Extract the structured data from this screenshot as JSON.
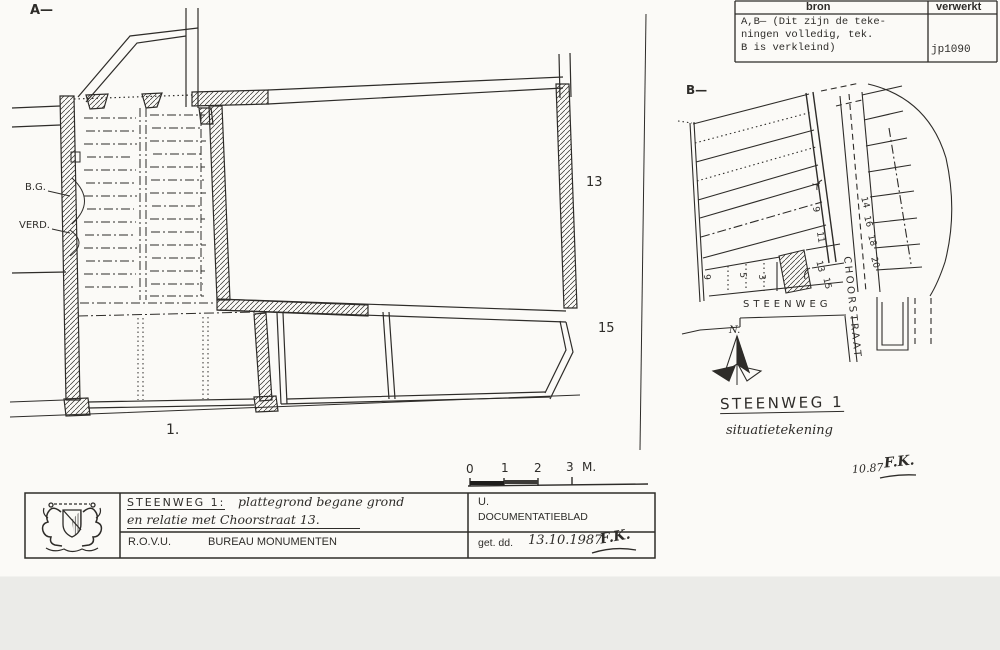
{
  "labels": {
    "a": "A—",
    "b": "B—",
    "bg": "B.G.",
    "verd": "VERD.",
    "n13": "13",
    "n15": "15",
    "n1": "1."
  },
  "scale_bar": {
    "t0": "0",
    "t1": "1",
    "t2": "2",
    "t3": "3",
    "unit": "M."
  },
  "source_table": {
    "header_bron": "bron",
    "header_verwerkt": "verwerkt",
    "line1": "A,B— (Dit zijn de teke-",
    "line2": "ningen volledig, tek.",
    "line3": "B is verkleind)",
    "code": "jp1090"
  },
  "situation_map": {
    "steenweg": "STEENWEG",
    "choorstraat": "CHOORSTRAAT",
    "north": "N.",
    "row": [
      "9",
      "5",
      "3"
    ],
    "odd": [
      "7",
      "9",
      "11",
      "13",
      "15"
    ],
    "even": [
      "14",
      "16",
      "18",
      "20"
    ],
    "title": "STEENWEG 1",
    "subtitle": "situatietekening",
    "date": "10.87",
    "initials": "F.K."
  },
  "title_block": {
    "line1a": "STEENWEG 1:",
    "line1b": "plattegrond begane grond",
    "line2": "en relatie met Choorstraat 13.",
    "org": "R.O.V.U.",
    "bureau": "BUREAU MONUMENTEN",
    "u": "U.",
    "doc": "DOCUMENTATIEBLAD",
    "get_dd": "get. dd.",
    "date": "13.10.1987",
    "sig": "F.K."
  },
  "colors": {
    "ink": "#2e2c29",
    "paper": "#fbfaf7",
    "scan_edge": "#ebebe8"
  }
}
